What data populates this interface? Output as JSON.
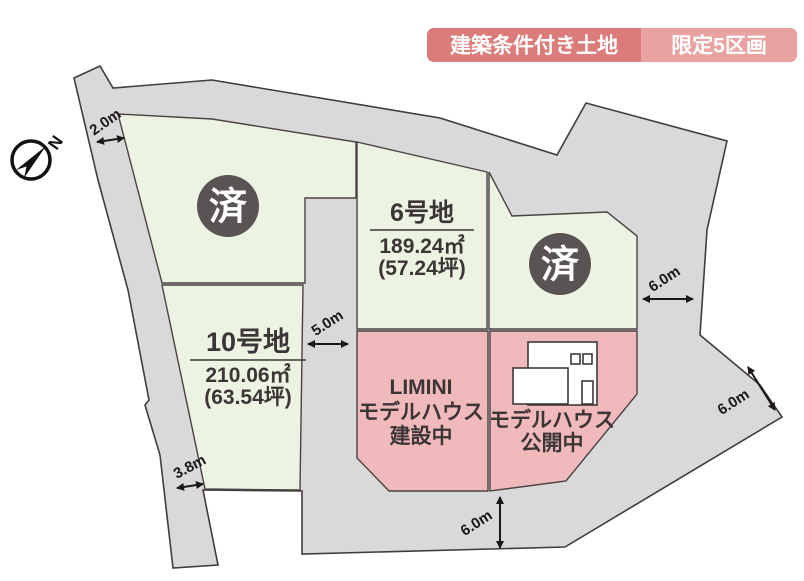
{
  "badge": {
    "left_label": "建築条件付き土地",
    "right_label": "限定5区画",
    "left_bg": "#db7c7b",
    "right_bg": "#e8a3a1"
  },
  "compass": {
    "label": "N"
  },
  "plots": {
    "sold_northwest": {
      "status_label": "済"
    },
    "sold_east": {
      "status_label": "済"
    },
    "plot6": {
      "name": "6号地",
      "area_m2": "189.24㎡",
      "area_tsubo": "(57.24坪)"
    },
    "plot10": {
      "name": "10号地",
      "area_m2": "210.06㎡",
      "area_tsubo": "(63.54坪)"
    },
    "model_construction": {
      "line1": "LIMINI",
      "line2": "モデルハウス",
      "line3": "建設中"
    },
    "model_open": {
      "line1": "モデルハウス",
      "line2": "公開中"
    }
  },
  "dimensions": {
    "top_left": "2.0m",
    "middle": "5.0m",
    "right": "6.0m",
    "diagonal": "6.0m",
    "bottom": "6.0m",
    "bottom_left": "3.8m"
  },
  "colors": {
    "road": "#d9d9da",
    "plot_available": "#edf3e2",
    "plot_model": "#f0b9bc",
    "sold_badge": "#595354",
    "outline": "#433b3c",
    "label_text": "#3b3536"
  }
}
